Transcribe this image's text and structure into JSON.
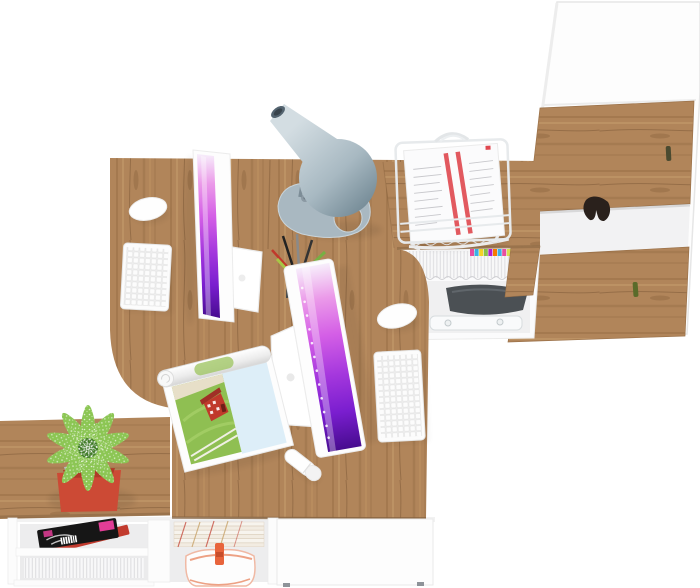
{
  "scene": {
    "background": "#ffffff",
    "description": "Top-down render of a white-and-oak office furniture set: two facing desks with monitors, keyboards and mice, desk lamp, pencil cup, wire paper tray with documents, tall storage cabinet with oak doors, under-desk magazine cubby, low sideboard with magazines, file folders, handbag and a succulent plant in a red pot",
    "counts": {
      "desks": 2,
      "monitors": 2,
      "keyboards": 2,
      "mice": 2,
      "cabinet_doors": 2,
      "plants": 1,
      "lamps": 1
    },
    "objects": [
      {
        "name": "desk-surface",
        "description": "L-shaped oak desktop with rounded corner cutouts"
      },
      {
        "name": "desk-return",
        "description": "oak return top joining desks to cabinet"
      },
      {
        "name": "monitor-1",
        "description": "white all-in-one monitor, screen facing left, purple abstract wallpaper"
      },
      {
        "name": "monitor-2",
        "description": "white all-in-one monitor, screen facing right, purple wallpaper with dock dots"
      },
      {
        "name": "keyboard-1",
        "description": "white wireless keyboard"
      },
      {
        "name": "keyboard-2",
        "description": "white wireless keyboard"
      },
      {
        "name": "mouse-1",
        "description": "white wireless mouse"
      },
      {
        "name": "mouse-2",
        "description": "white wireless mouse"
      },
      {
        "name": "desk-lamp",
        "description": "gray cone desk lamp with flat looped base"
      },
      {
        "name": "pencil-cup",
        "description": "dark mesh cup with pens and pencils"
      },
      {
        "name": "paper-tray",
        "description": "white wire letter tray holding documents with red stripes"
      },
      {
        "name": "storage-cabinet",
        "description": "tall white cabinet with two oak doors and green pull handles"
      },
      {
        "name": "magazine-cubby",
        "description": "under-return shelf with white binders and colored index tabs"
      },
      {
        "name": "sideboard",
        "description": "low white sideboard with oak top"
      },
      {
        "name": "plant",
        "description": "speckled green succulent in red square pot"
      },
      {
        "name": "open-magazine",
        "description": "rolled-open magazine showing red barn in green field"
      },
      {
        "name": "usb-stick",
        "description": "white usb flash drive"
      },
      {
        "name": "fashion-magazine",
        "description": "black cover magazine with pink titles"
      },
      {
        "name": "red-book",
        "description": "red hardcover book"
      },
      {
        "name": "file-folders",
        "description": "stack of striped document folders"
      },
      {
        "name": "handbag",
        "description": "white handbag with orange straps"
      }
    ]
  },
  "colors": {
    "wood_base": "#b1855a",
    "wood_grain_dark": "#8a6239",
    "wood_grain_light": "#d8af7c",
    "wood_edge": "#96714a",
    "furniture_white": "#fdfdfd",
    "outline_gray": "#e8e8e8",
    "screen_stop_1": "#f7eefb",
    "screen_stop_2": "#eb9ae9",
    "screen_stop_3": "#d45fe6",
    "screen_stop_4": "#a437dd",
    "screen_stop_5": "#7a1ecf",
    "screen_stop_6": "#470c8f",
    "lamp_light": "#d3dde2",
    "lamp_mid": "#a8b9c2",
    "lamp_dark": "#6d8490",
    "leaf_dark": "#35701f",
    "leaf_mid": "#4f8f2c",
    "leaf_light": "#8cc654",
    "pot_red": "#cc4a35",
    "paper_stripe_red": "#e0484f",
    "magazine_pink": "#e23d96",
    "book_red": "#c23b2e",
    "barn_red": "#c0392b",
    "bag_orange": "#e8643c",
    "handle_olive": "#4a4a30",
    "handle_green": "#5a6b2a",
    "dark_bag_gray": "#4b5054",
    "glove_dark": "#2a211c"
  },
  "storage": {
    "tab_colors": [
      "#e84fa0",
      "#3bb3e6",
      "#f5d327",
      "#8bc34a",
      "#b31fd0",
      "#f57c00",
      "#3bb3e6",
      "#e84fa0",
      "#d6e24f",
      "#4fe8b3"
    ]
  }
}
